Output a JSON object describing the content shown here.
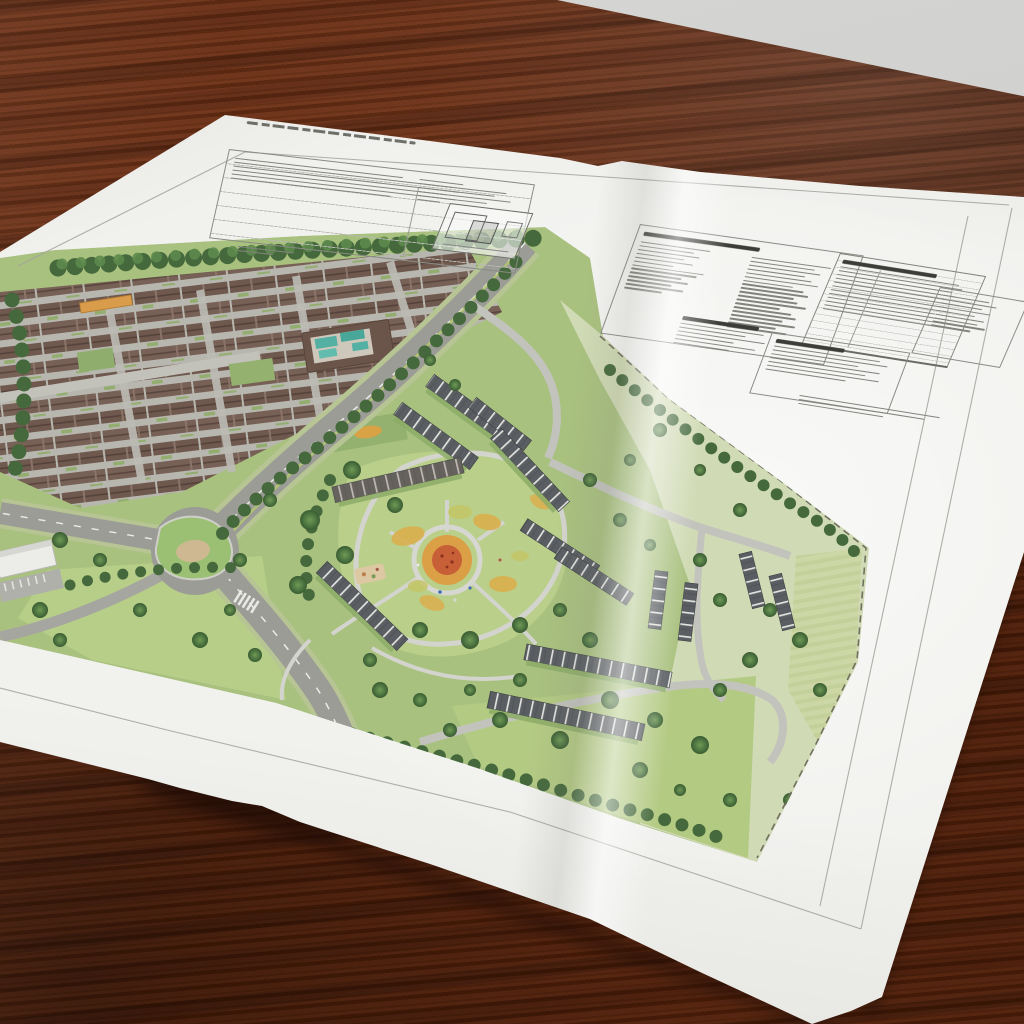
{
  "scene": {
    "subject": "printed residential masterplan site-plan sheet on a dark wooden table",
    "colors": {
      "wall": "#cdcdcb",
      "wood_base": "#5d2711",
      "wood_light": "#7b3a21",
      "paper": "#f1f1ee",
      "map_grass": "#a9c17f",
      "map_lawn_light": "#b6ce88",
      "map_tree_dark": "#45693c",
      "map_road": "#9c9c96",
      "map_path": "#d0d0ca",
      "roof_brown": "#6f584d",
      "roof_grey": "#5a5e62",
      "flower_bed_orange": "#db9f46",
      "flower_bed_red": "#c65a36",
      "pool_teal": "#55b0a4",
      "footpath_orange": "#d99c4a",
      "pale_fields": "#d0dab4",
      "frame_line": "#a2a29c"
    }
  },
  "sheet": {
    "title": {
      "text": "",
      "legible": false,
      "style": "thin handwritten-style drawing title, illegible"
    },
    "blocks": {
      "title_table": {
        "lines": [
          58,
          94,
          90,
          96,
          88,
          55
        ]
      },
      "title_sub": {
        "lines": [
          82,
          52
        ]
      },
      "mini_notes": {
        "lines": [
          92,
          70,
          85,
          58,
          80,
          48
        ]
      },
      "legend": {
        "col_a": [
          70,
          55,
          62,
          48,
          58,
          40,
          72,
          66,
          52,
          60,
          45,
          58,
          38
        ],
        "col_b": [
          80,
          65,
          72,
          58,
          66,
          74,
          50,
          62,
          68,
          55,
          60,
          70,
          45,
          58,
          64,
          52,
          66,
          48,
          60
        ]
      },
      "schedule": {
        "lines": [
          88,
          92,
          85,
          90,
          82,
          94,
          86,
          90,
          80,
          92,
          84,
          88
        ]
      },
      "side_table": {
        "lines": [
          60,
          72,
          55,
          68,
          50,
          64,
          58,
          70,
          52
        ]
      },
      "notes_a": {
        "lines": [
          88,
          70,
          92,
          60,
          84,
          58
        ]
      },
      "notes_b": {
        "lines": [
          85,
          92,
          70,
          88,
          78,
          90,
          64
        ]
      },
      "notes_b_tail": {
        "lines": [
          96,
          86,
          58
        ]
      }
    }
  }
}
